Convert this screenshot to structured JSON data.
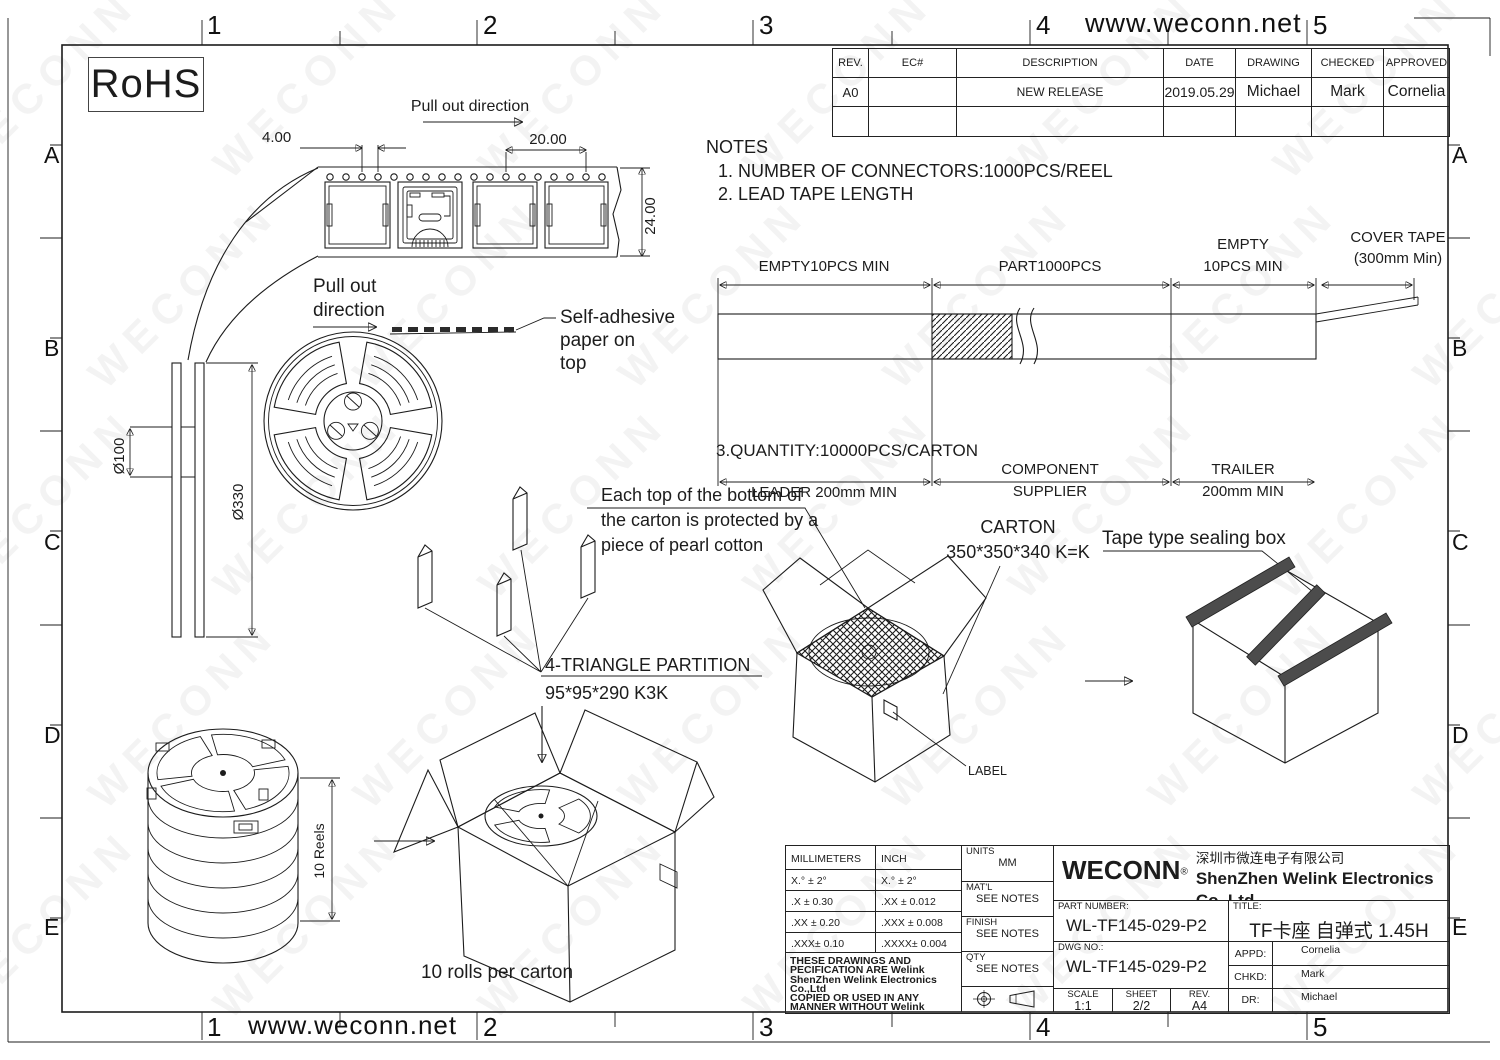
{
  "watermark": {
    "text": "WECONN"
  },
  "header": {
    "website": "www.weconn.net"
  },
  "zones": {
    "cols": [
      "1",
      "2",
      "3",
      "4",
      "5"
    ],
    "rows": [
      "A",
      "B",
      "C",
      "D",
      "E"
    ]
  },
  "rohs": "RoHS",
  "revision_table": {
    "headers": [
      "REV.",
      "EC#",
      "DESCRIPTION",
      "DATE",
      "DRAWING",
      "CHECKED",
      "APPROVED"
    ],
    "rows": [
      {
        "rev": "A0",
        "ec": "",
        "description": "NEW RELEASE",
        "date": "2019.05.29",
        "drawing": "Michael",
        "checked": "Mark",
        "approved": "Cornelia"
      },
      {
        "rev": "",
        "ec": "",
        "description": "",
        "date": "",
        "drawing": "",
        "checked": "",
        "approved": ""
      }
    ]
  },
  "carrier_tape": {
    "pull_out": "Pull out direction",
    "dim_pitch": "4.00",
    "dim_span": "20.00",
    "dim_width": "24.00"
  },
  "reel": {
    "pull_out_1": "Pull out",
    "pull_out_2": "direction",
    "adhesive_1": "Self-adhesive",
    "adhesive_2": "paper on",
    "adhesive_3": "top",
    "dia_inner": "Ø100",
    "dia_outer": "Ø330"
  },
  "notes": {
    "title": "NOTES",
    "item1": "1. NUMBER OF CONNECTORS:1000PCS/REEL",
    "item2": "2. LEAD TAPE LENGTH",
    "item3": "3.QUANTITY:10000PCS/CARTON"
  },
  "tape_layout": {
    "empty_left": "EMPTY10PCS MIN",
    "part": "PART1000PCS",
    "empty_right_1": "EMPTY",
    "empty_right_2": "10PCS MIN",
    "cover_1": "COVER TAPE",
    "cover_2": "(300mm Min)",
    "leader": "LEADER 200mm MIN",
    "supplier_1": "COMPONENT",
    "supplier_2": "SUPPLIER",
    "trailer_1": "TRAILER",
    "trailer_2": "200mm MIN"
  },
  "packing": {
    "pearl_1": "Each top of the bottom of",
    "pearl_2": "the carton is protected by a",
    "pearl_3": "piece of pearl cotton",
    "carton_1": "CARTON",
    "carton_2": "350*350*340 K=K",
    "sealing_box": "Tape type sealing box",
    "partition_1": "4-TRIANGLE PARTITION",
    "partition_2": "95*95*290 K3K",
    "label": "LABEL",
    "reels_dim": "10 Reels",
    "rolls_note": "10 rolls per carton"
  },
  "title_block": {
    "tol": {
      "col_mm": "MILLIMETERS",
      "col_inch": "INCH",
      "rows": [
        [
          "X.° ± 2°",
          "X.° ± 2°"
        ],
        [
          ".X   ± 0.30",
          ".XX   ± 0.012"
        ],
        [
          ".XX  ± 0.20",
          ".XXX  ± 0.008"
        ],
        [
          ".XXX± 0.10",
          ".XXXX± 0.004"
        ]
      ]
    },
    "legal_1": "THESE DRAWINGS AND PECIFICATION ARE Welink",
    "legal_2": "ShenZhen Welink Electronics Co.,Ltd",
    "legal_3": "COPIED OR USED IN ANY MANNER WITHOUT Welink",
    "legal_4": "ShenZhen Welink Electronics Co.,Ltd",
    "units_label": "UNITS",
    "units_value": "MM",
    "matl_label": "MAT'L",
    "matl_value": "SEE NOTES",
    "finish_label": "FINISH",
    "finish_value": "SEE NOTES",
    "qty_label": "QTY",
    "qty_value": "SEE NOTES",
    "company": {
      "logo": "WECONN",
      "reg": "®",
      "name_cn": "深圳市微连电子有限公司",
      "name_en": "ShenZhen Welink Electronics Co.,Ltd"
    },
    "part_number_label": "PART NUMBER:",
    "part_number": "WL-TF145-029-P2",
    "title_label": "TITLE:",
    "title": "TF卡座 自弹式 1.45H",
    "dwg_label": "DWG NO.:",
    "dwg_no": "WL-TF145-029-P2",
    "appd_label": "APPD:",
    "appd": "Cornelia",
    "chkd_label": "CHKD:",
    "chkd": "Mark",
    "dr_label": "DR:",
    "dr": "Michael",
    "scale_label": "SCALE",
    "scale": "1:1",
    "sheet_label": "SHEET",
    "sheet": "2/2",
    "rev_label": "REV.",
    "rev": "A4"
  }
}
